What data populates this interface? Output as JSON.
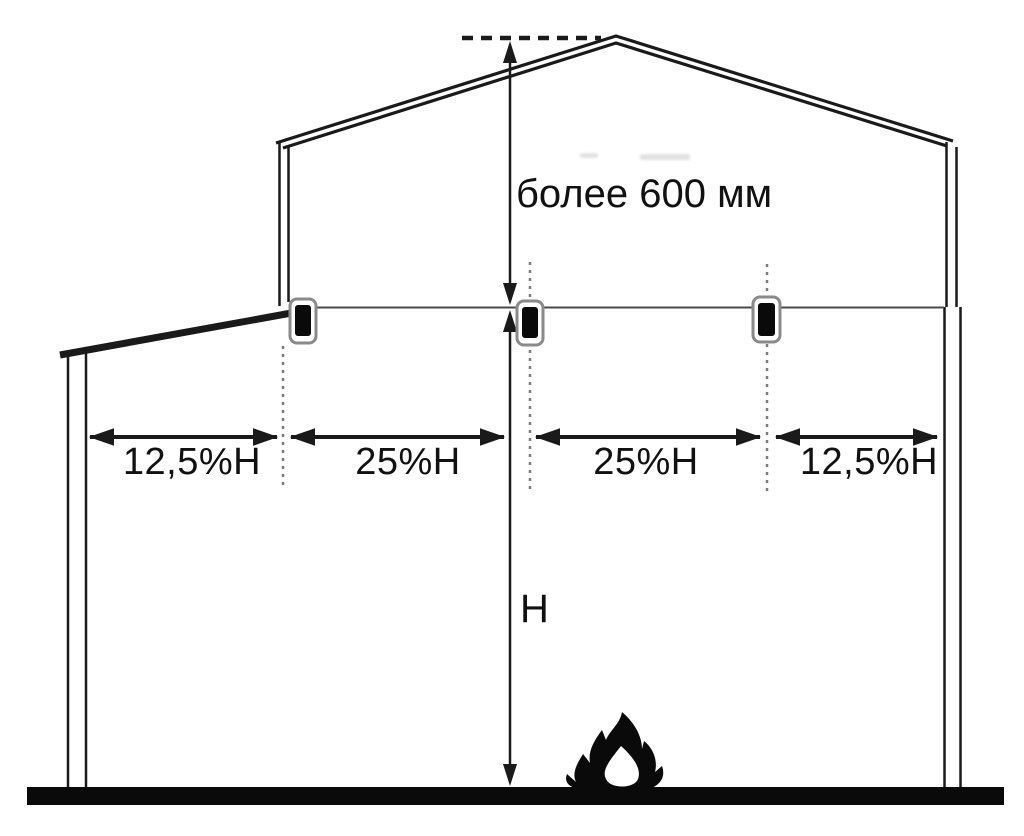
{
  "diagram": {
    "type": "building-cross-section-detector-spacing",
    "labels": {
      "apex_clearance": "более 600 мм",
      "building_height": "H"
    },
    "dimension_segments": [
      {
        "label": "12,5%H"
      },
      {
        "label": "25%H"
      },
      {
        "label": "25%H"
      },
      {
        "label": "12,5%H"
      }
    ],
    "detector_count": 3,
    "icons": {
      "detector": "smoke-detector-icon",
      "fire": "flame-icon"
    },
    "colors": {
      "line": "#1a1a1a",
      "ceiling_line": "#4a4a4a",
      "guide_dash": "#7d7d7d",
      "background": "#ffffff"
    }
  }
}
